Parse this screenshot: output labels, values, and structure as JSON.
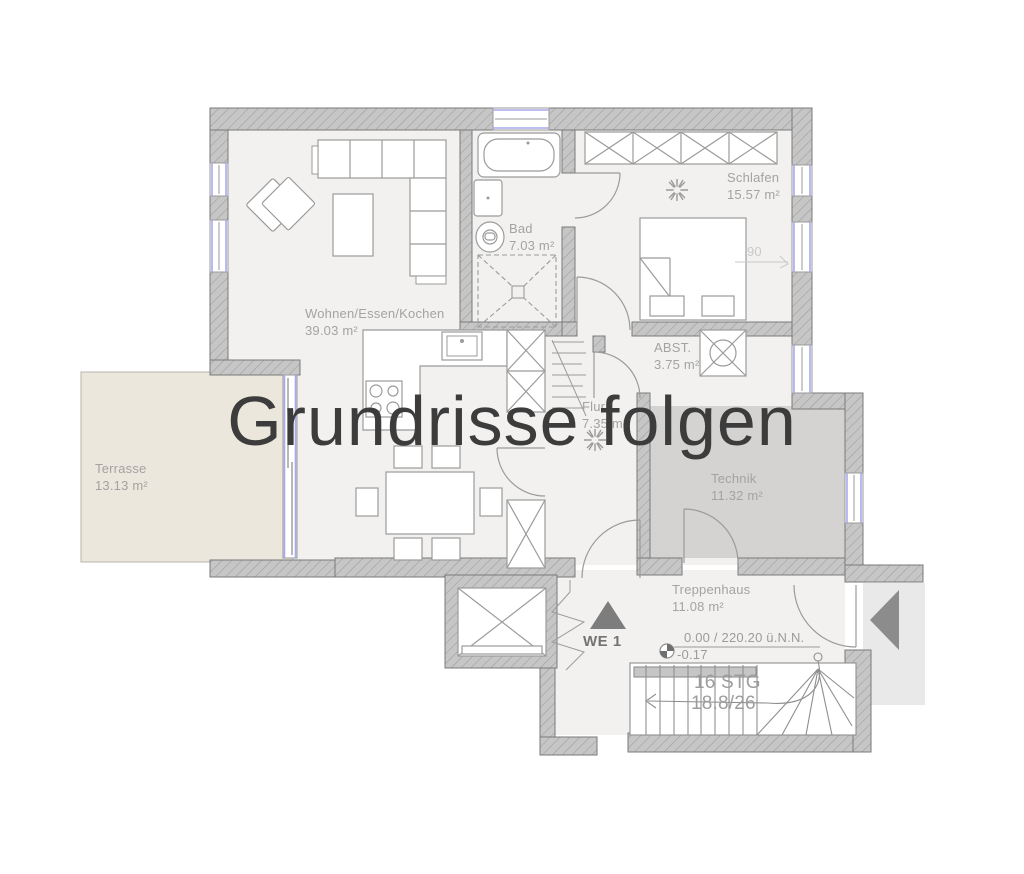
{
  "watermark": "Grundrisse folgen",
  "rooms": [
    {
      "id": "wohnen",
      "name": "Wohnen/Essen/Kochen",
      "area": "39.03 m²"
    },
    {
      "id": "bad",
      "name": "Bad",
      "area": "7.03 m²"
    },
    {
      "id": "schlafen",
      "name": "Schlafen",
      "area": "15.57 m²"
    },
    {
      "id": "abst",
      "name": "ABST.",
      "area": "3.75 m²"
    },
    {
      "id": "flur",
      "name": "Flur",
      "area": "7.35 m²"
    },
    {
      "id": "technik",
      "name": "Technik",
      "area": "11.32 m²"
    },
    {
      "id": "treppenhaus",
      "name": "Treppenhaus",
      "area": "11.08 m²"
    },
    {
      "id": "terrasse",
      "name": "Terrasse",
      "area": "13.13 m²"
    }
  ],
  "markers": {
    "unit_label": "WE 1",
    "elevation_upper": "0.00 / 220.20 ü.N.N.",
    "elevation_lower": "-0.17",
    "stairs_line1": "16 STG",
    "stairs_line2": "18.8/26",
    "door_width_dim": "90"
  },
  "icons": [
    "sun-light-icon",
    "washing-machine-icon",
    "toilet-icon",
    "bathtub-icon",
    "washbasin-icon",
    "shower-icon",
    "wardrobe-icon",
    "elevator-icon",
    "radiator-icon",
    "entrance-arrow-icon",
    "unit-marker-triangle-icon",
    "elevation-marker-icon",
    "stairs-icon"
  ],
  "colors": {
    "wall_fill": "#c6c6c6",
    "wall_hatch": "#9a9a9a",
    "wall_outline": "#7a7a7a",
    "floor": "#f2f1ef",
    "technik_floor": "#d4d3d1",
    "terrace_floor": "#ece7dd",
    "window_accent": "#a9a9ee",
    "furniture_stroke": "#9b9b9b",
    "label_gray": "#a3a3a2",
    "watermark_gray": "#3c3c3c",
    "marker_dark": "#7d7d7d",
    "entry_platform": "#e9e9e9"
  }
}
